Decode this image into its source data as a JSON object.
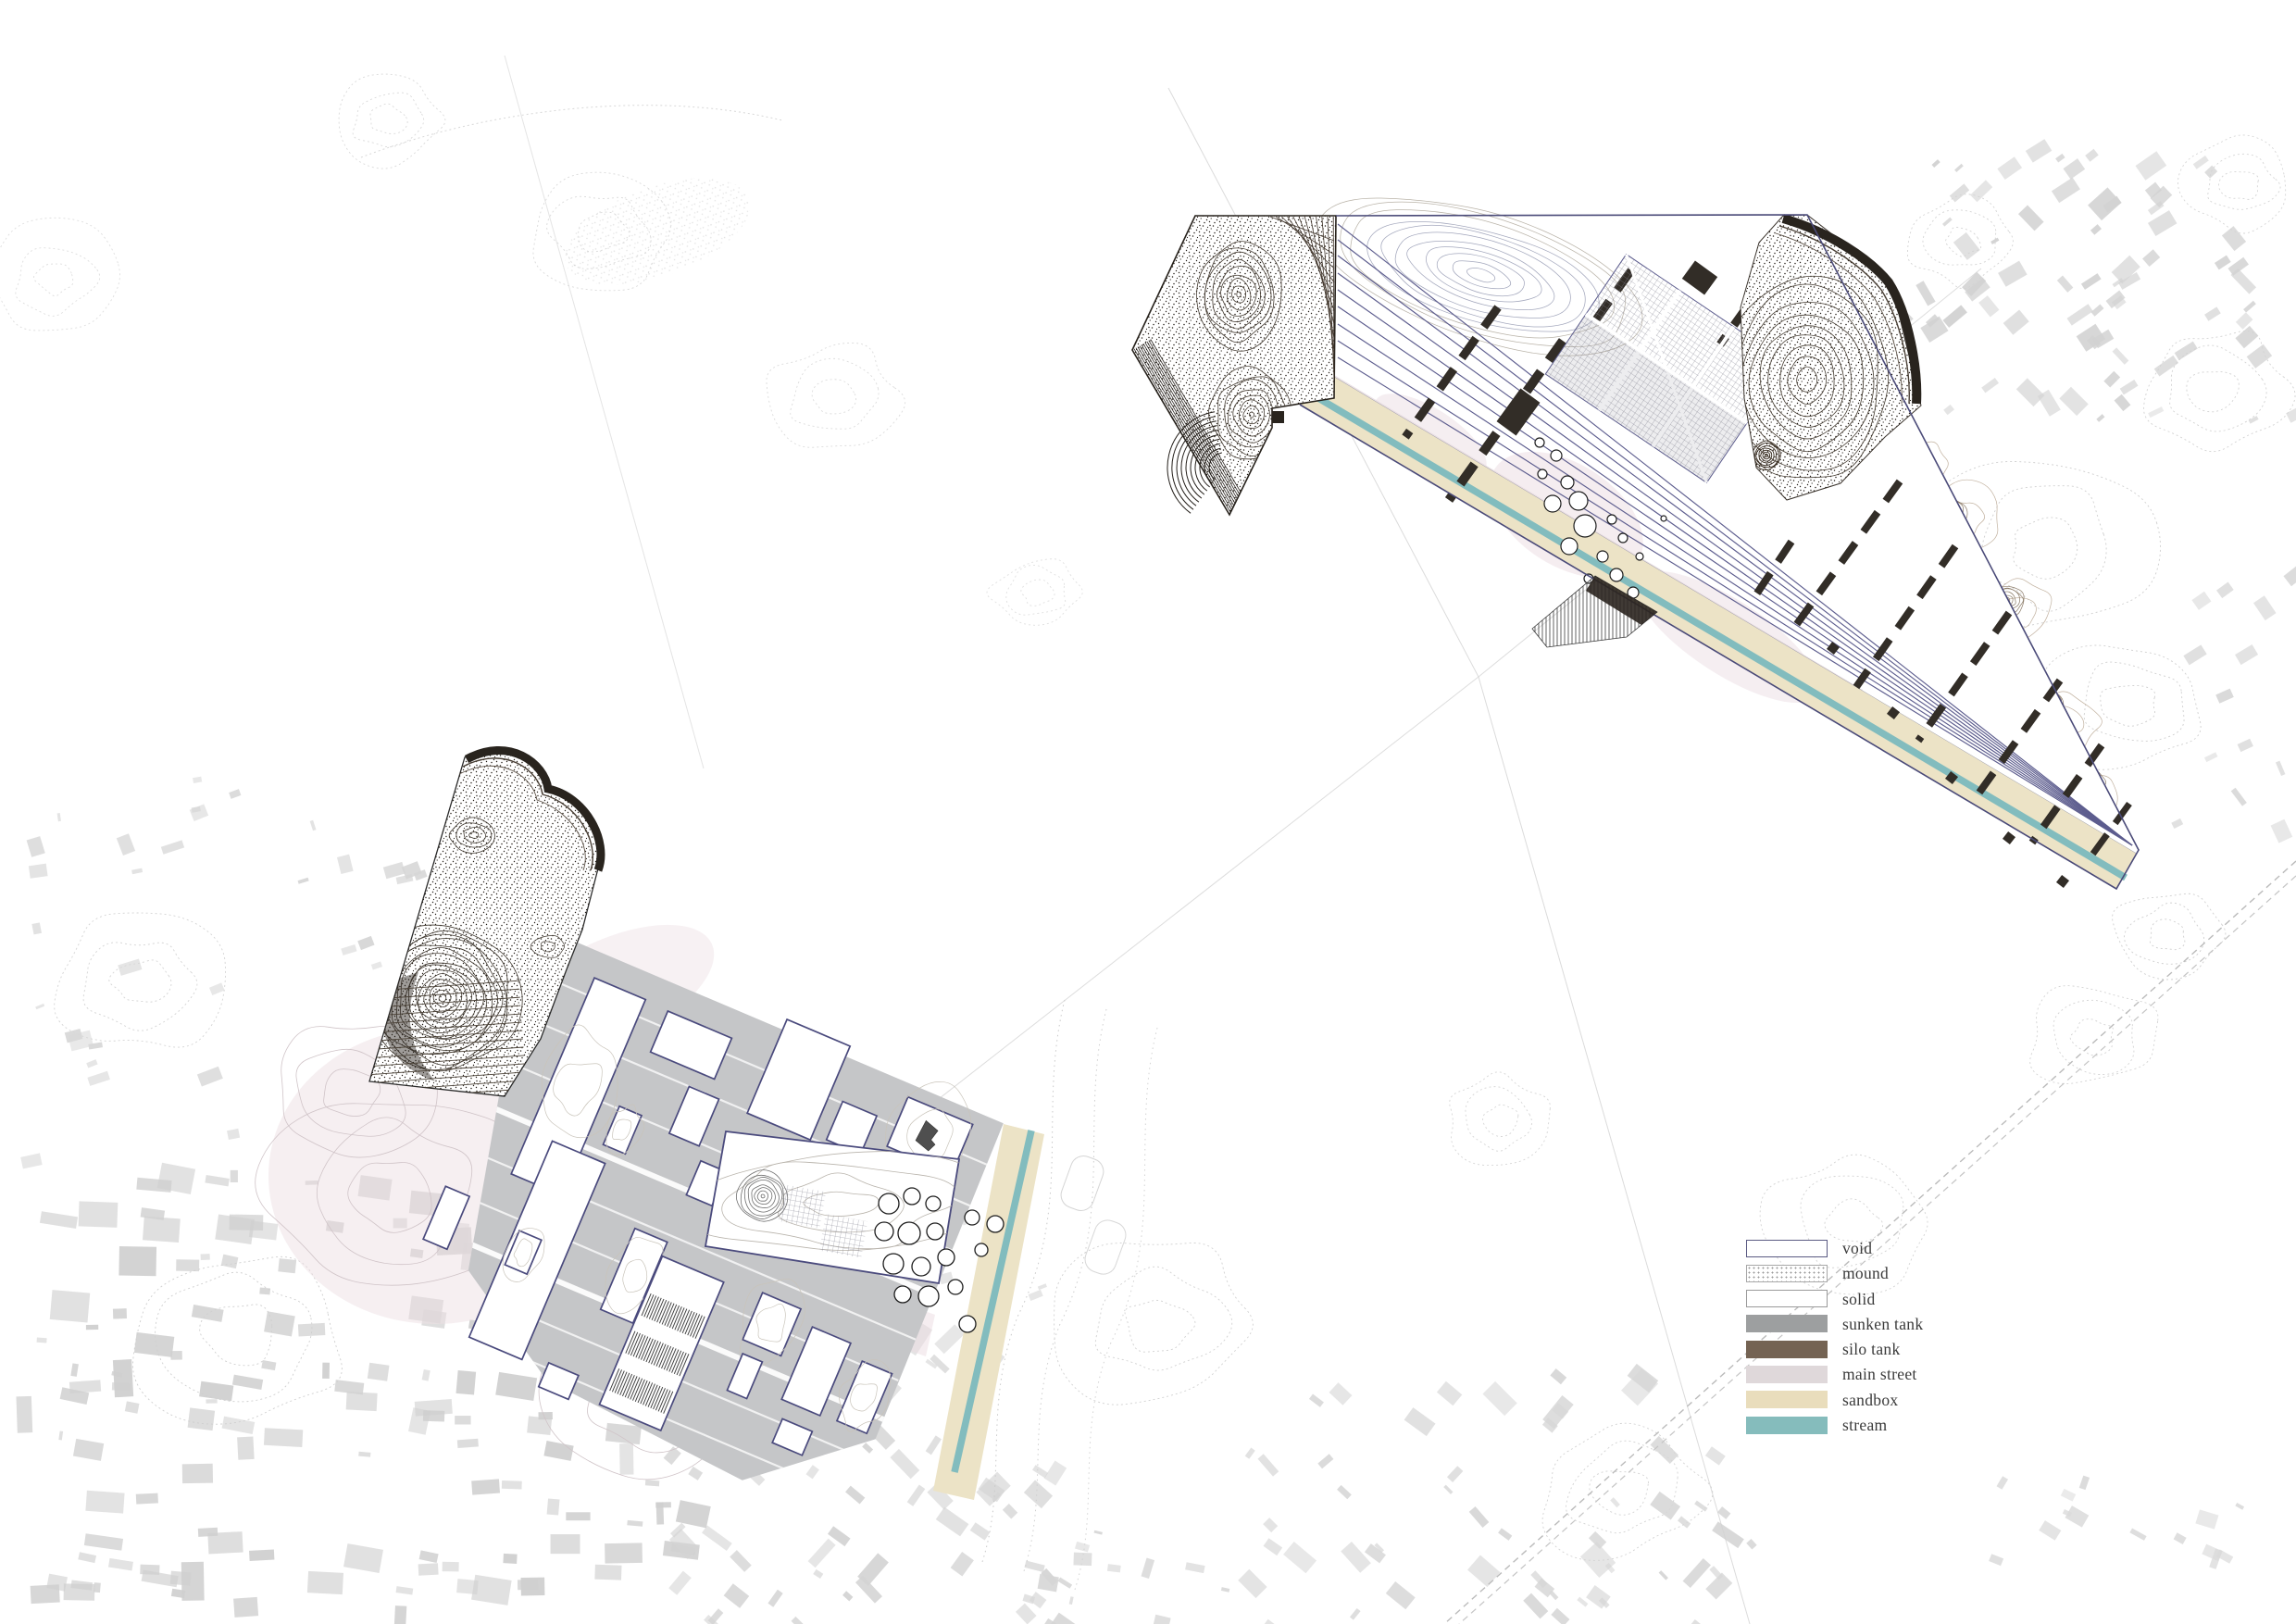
{
  "legend": {
    "items": [
      {
        "key": "void",
        "label": "void",
        "fill": "#ffffff",
        "border": "#5a5a82",
        "texture": "none"
      },
      {
        "key": "mound",
        "label": "mound",
        "fill": "#ffffff",
        "border": "#a8a8a8",
        "texture": "stipple"
      },
      {
        "key": "solid",
        "label": "solid",
        "fill": "#ffffff",
        "border": "#9a9a9a",
        "texture": "none"
      },
      {
        "key": "sunken_tank",
        "label": "sunken tank",
        "fill": "#9d9fa0",
        "border": "none",
        "texture": "none"
      },
      {
        "key": "silo_tank",
        "label": "silo tank",
        "fill": "#746353",
        "border": "none",
        "texture": "none"
      },
      {
        "key": "main_street",
        "label": "main street",
        "fill": "#dfd8da",
        "border": "none",
        "texture": "none"
      },
      {
        "key": "sandbox",
        "label": "sandbox",
        "fill": "#e9ddbc",
        "border": "none",
        "texture": "none"
      },
      {
        "key": "stream",
        "label": "stream",
        "fill": "#85bcbc",
        "border": "none",
        "texture": "none"
      }
    ]
  },
  "palette": {
    "site_outline_navy": "#4a4a78",
    "plot_strip_line": "#5d5d8e",
    "void_border": "#4a4a7d",
    "sunken_tank_gray": "#c5c6c8",
    "silo_tank_dark": "#322d27",
    "main_street_pink": "#e9dfe3",
    "sandbox_beige": "#ece3c6",
    "stream_teal": "#82bcbe",
    "city_fabric_gray": "#d4d4d4",
    "contour_brown": "#8b7b68",
    "legend_text": "#3a3a3a"
  }
}
